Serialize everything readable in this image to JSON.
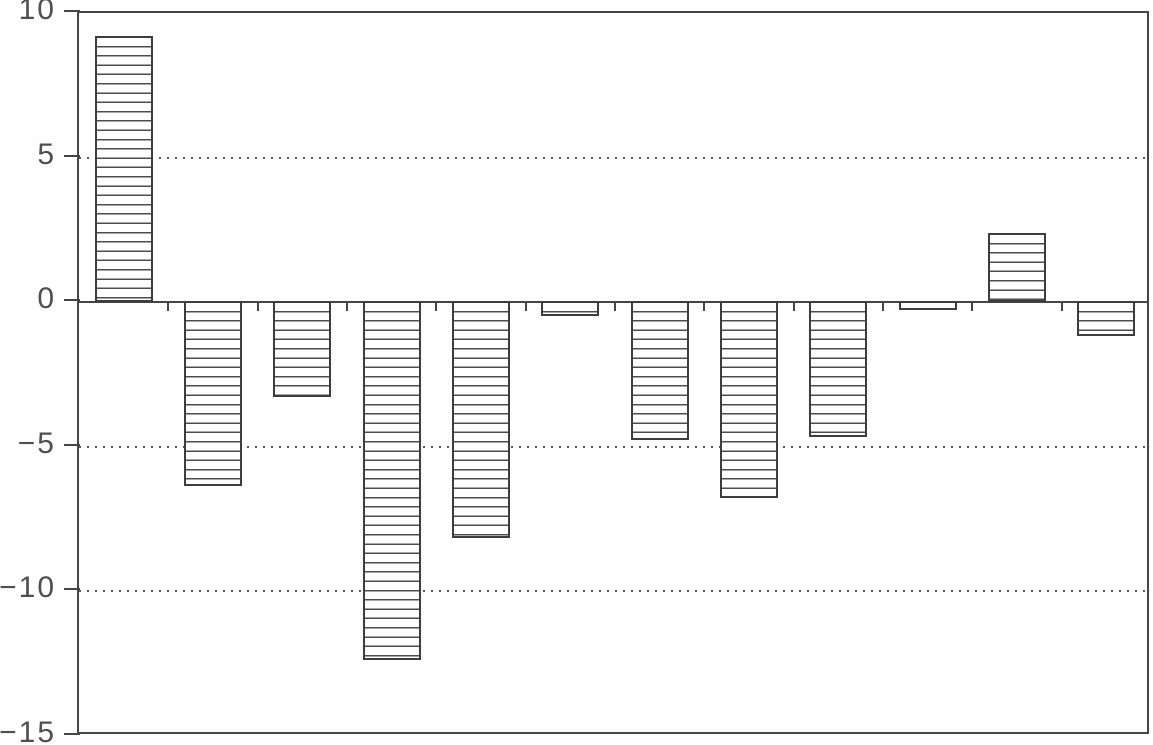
{
  "chart_data": {
    "type": "bar",
    "categories": [
      "",
      "",
      "",
      "",
      "",
      "",
      "",
      "",
      "",
      "",
      "",
      ""
    ],
    "values": [
      9.2,
      -6.4,
      -3.3,
      -12.4,
      -8.2,
      -0.5,
      -4.8,
      -6.8,
      -4.7,
      -0.3,
      2.4,
      -1.2
    ],
    "title": "",
    "xlabel": "",
    "ylabel": "",
    "ylim": [
      -15,
      10
    ],
    "yticks": [
      10,
      5,
      0,
      -5,
      -10,
      -15
    ],
    "ytick_labels": [
      "10",
      "5",
      "0",
      "−5",
      "−10",
      "−15"
    ],
    "dotted_gridlines_at": [
      5,
      -5,
      -10
    ],
    "zero_axis": "solid",
    "x_axis_ticks": "short ticks below zero line between bars",
    "legend_position": "none",
    "bar_fill": "horizontal-line hatch on white",
    "frame": "full rectangular border"
  },
  "style": {
    "line_color": "#454545",
    "hatch_color": "#4d4d4d",
    "label_color": "#4f4f4f",
    "background_color": "#fefefe"
  }
}
